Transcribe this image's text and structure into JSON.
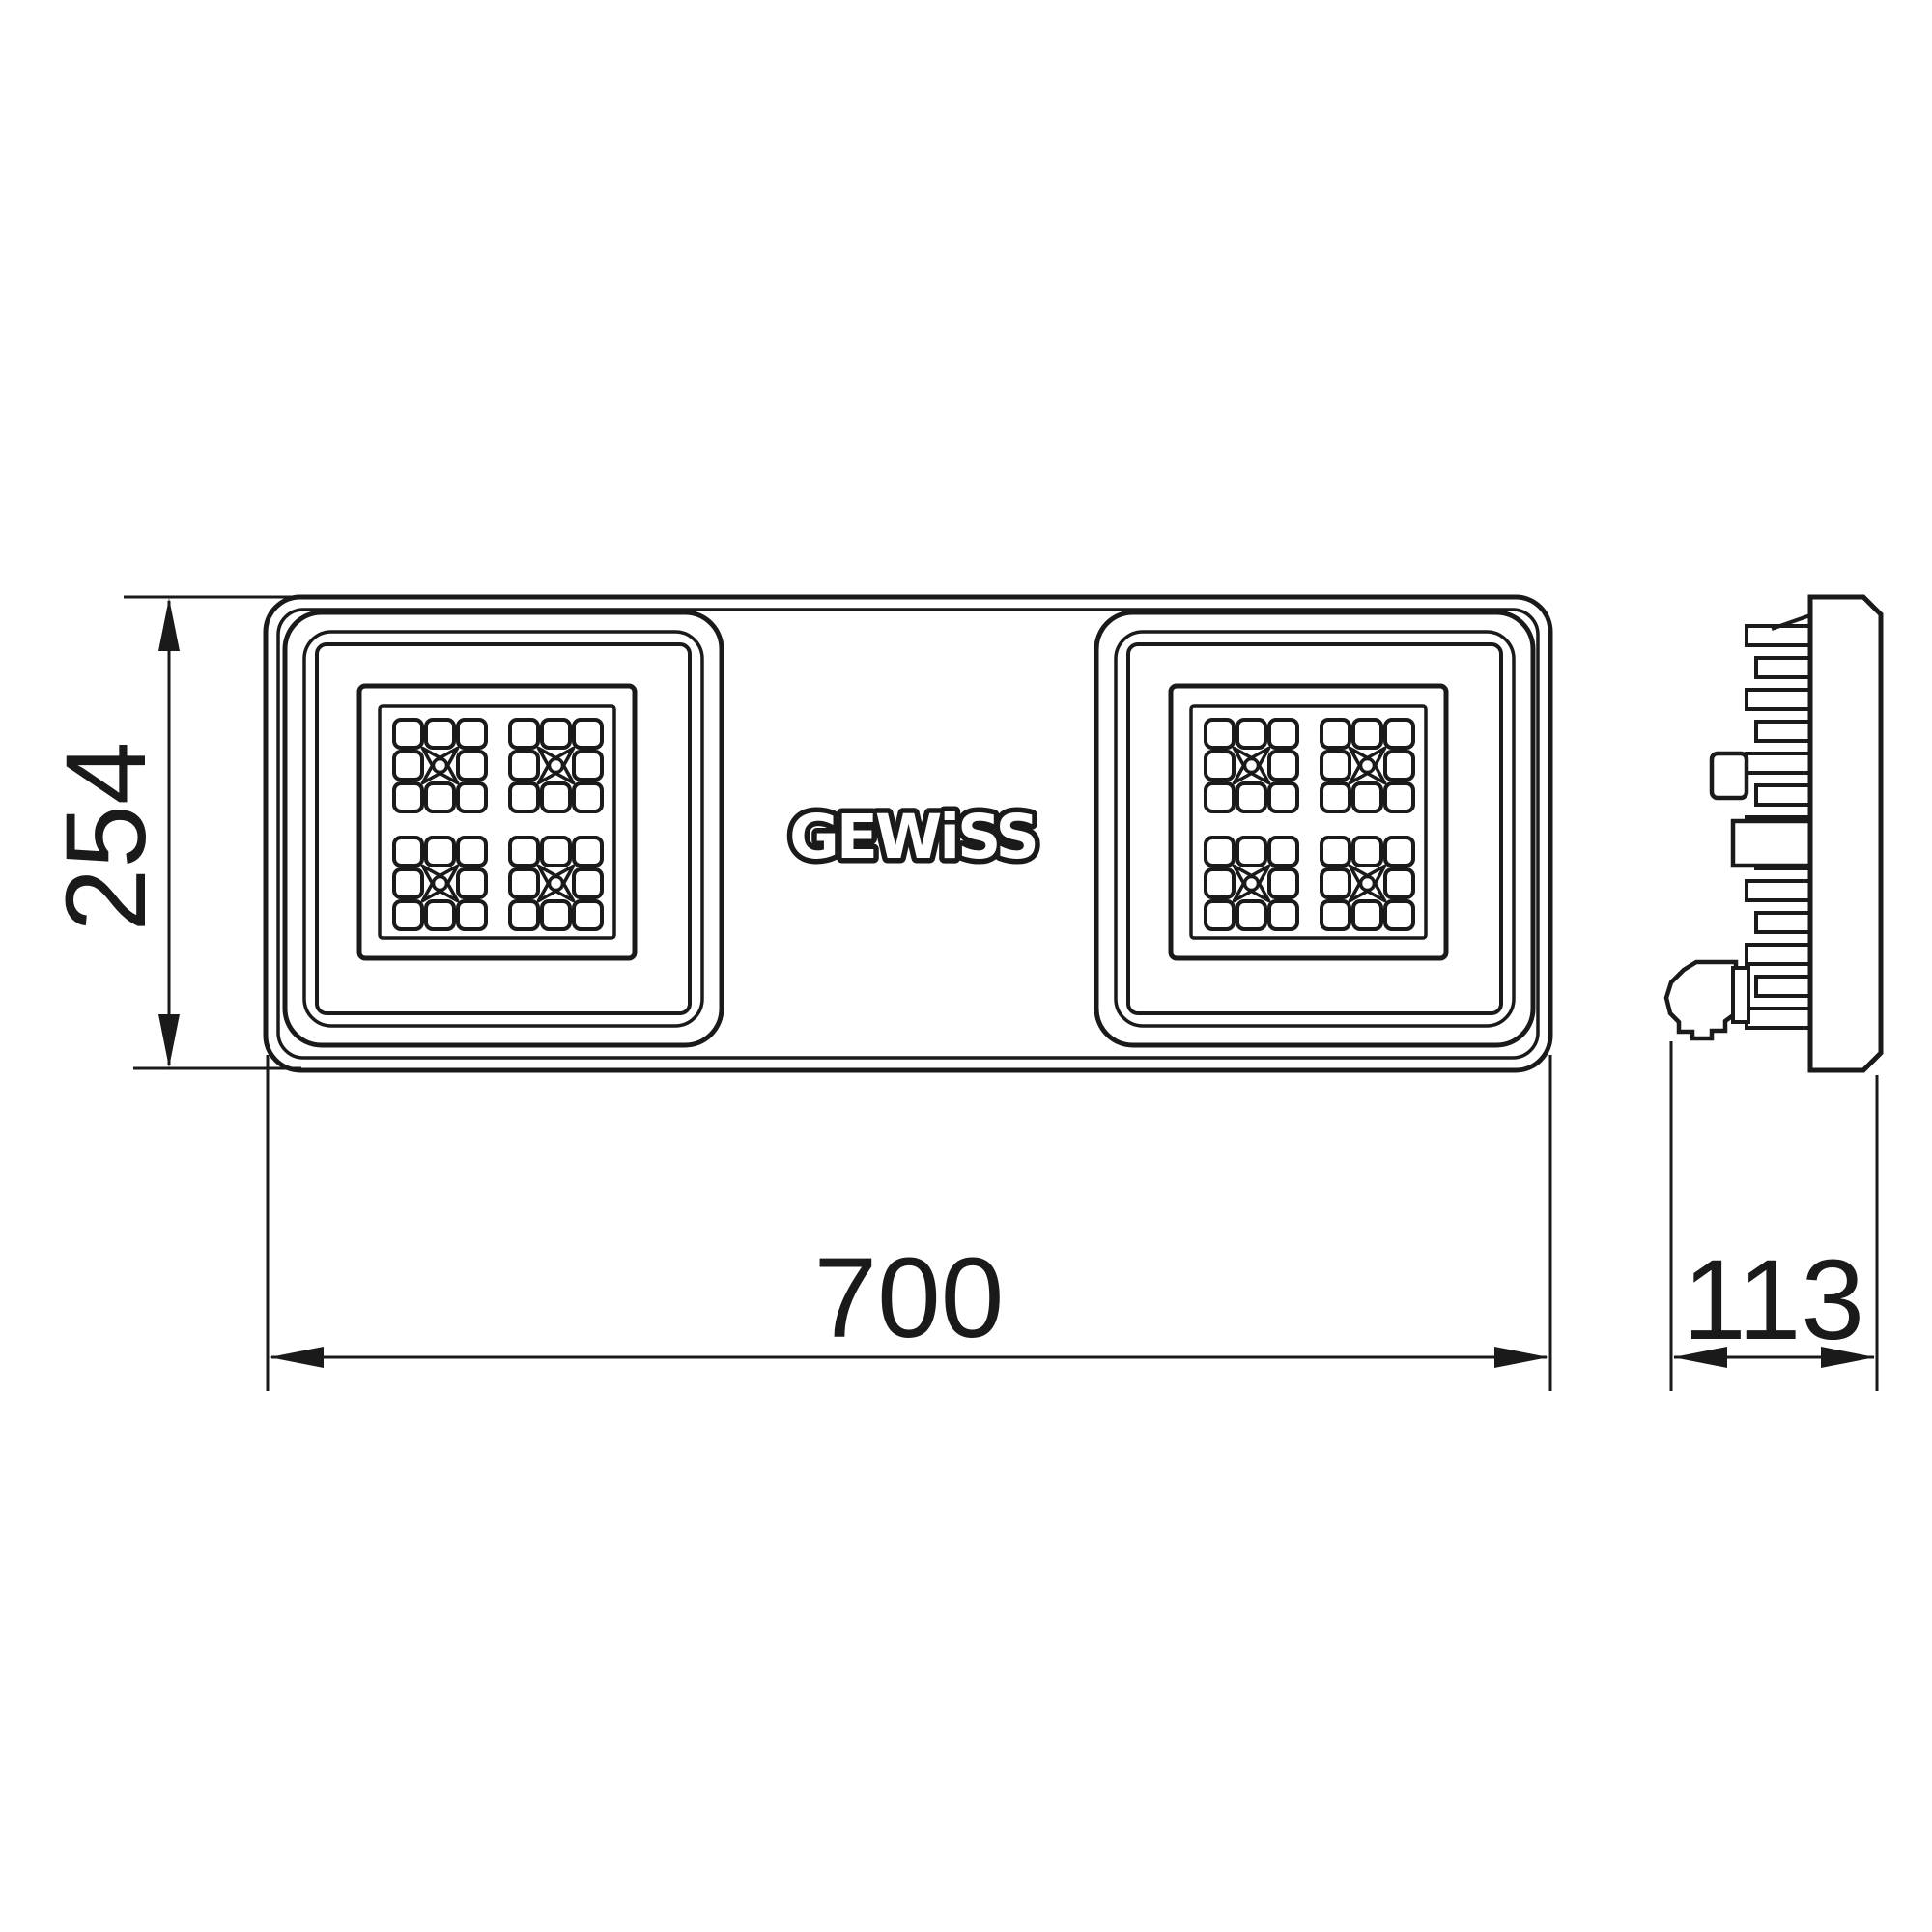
{
  "drawing": {
    "type": "product-dimension-drawing",
    "brand": {
      "logo_text": "GEWiSS"
    },
    "dimensions": {
      "height_label": "254",
      "width_label": "700",
      "depth_label": "113"
    },
    "colors": {
      "line": "#1a1a1a",
      "background": "#ffffff"
    }
  }
}
